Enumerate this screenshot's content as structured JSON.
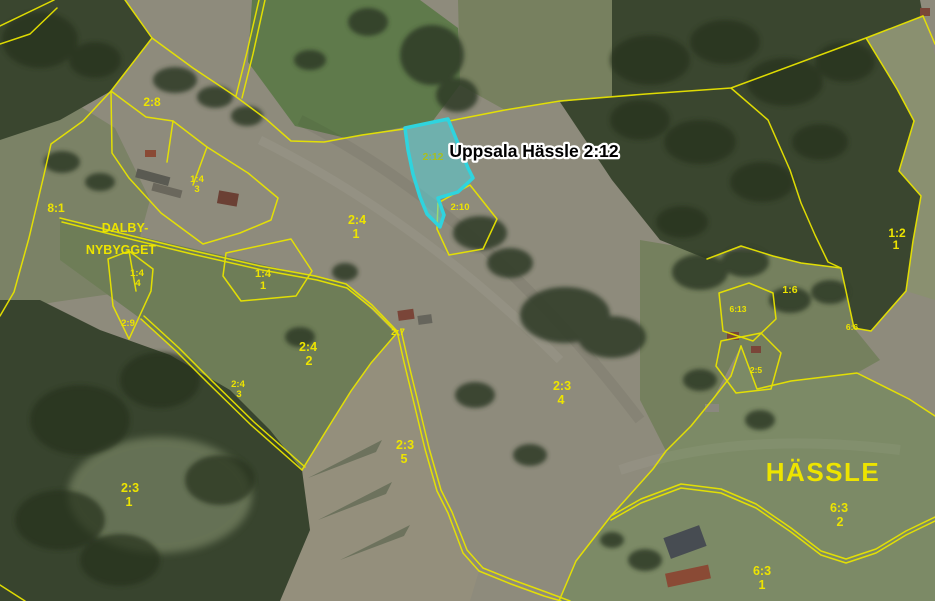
{
  "map_title": "Uppsala Hässle 2:12",
  "highlight": {
    "parcel_label": "2:12",
    "annotation": "Uppsala Hässle 2:12"
  },
  "place_names": {
    "dalby_line1": "DALBY-",
    "dalby_line2": "NYBYGGET",
    "hassle": "HÄSSLE"
  },
  "parcels": {
    "p2_8": {
      "id": "2:8"
    },
    "p8_1": {
      "id": "8:1"
    },
    "p1_4_3": {
      "id": "1:4",
      "unit": "3"
    },
    "p1_4_4": {
      "id": "1:4",
      "unit": "4"
    },
    "p2_9": {
      "id": "2:9"
    },
    "p1_4_1": {
      "id": "1:4",
      "unit": "1"
    },
    "p2_4_1": {
      "id": "2:4",
      "unit": "1"
    },
    "p2_10": {
      "id": "2:10"
    },
    "p2_7": {
      "id": "2:7"
    },
    "p2_4_2": {
      "id": "2:4",
      "unit": "2"
    },
    "p2_4_3": {
      "id": "2:4",
      "unit": "3"
    },
    "p2_3_4": {
      "id": "2:3",
      "unit": "4"
    },
    "p2_3_5": {
      "id": "2:3",
      "unit": "5"
    },
    "p2_3_1": {
      "id": "2:3",
      "unit": "1"
    },
    "p1_2_1": {
      "id": "1:2",
      "unit": "1"
    },
    "p1_6": {
      "id": "1:6"
    },
    "p6_13": {
      "id": "6:13"
    },
    "p6_6": {
      "id": "6:6"
    },
    "p2_5": {
      "id": "2:5"
    },
    "p6_3_2": {
      "id": "6:3",
      "unit": "2"
    },
    "p6_3_1": {
      "id": "6:3",
      "unit": "1"
    }
  },
  "colors": {
    "boundary": "#e8e400",
    "label": "#ede400",
    "highlight_stroke": "#2fd4de",
    "highlight_fill": "rgba(79,214,222,0.5)",
    "highlight_label": "#a9bf1e",
    "annotation_text": "#000000",
    "annotation_halo": "#ffffff"
  }
}
